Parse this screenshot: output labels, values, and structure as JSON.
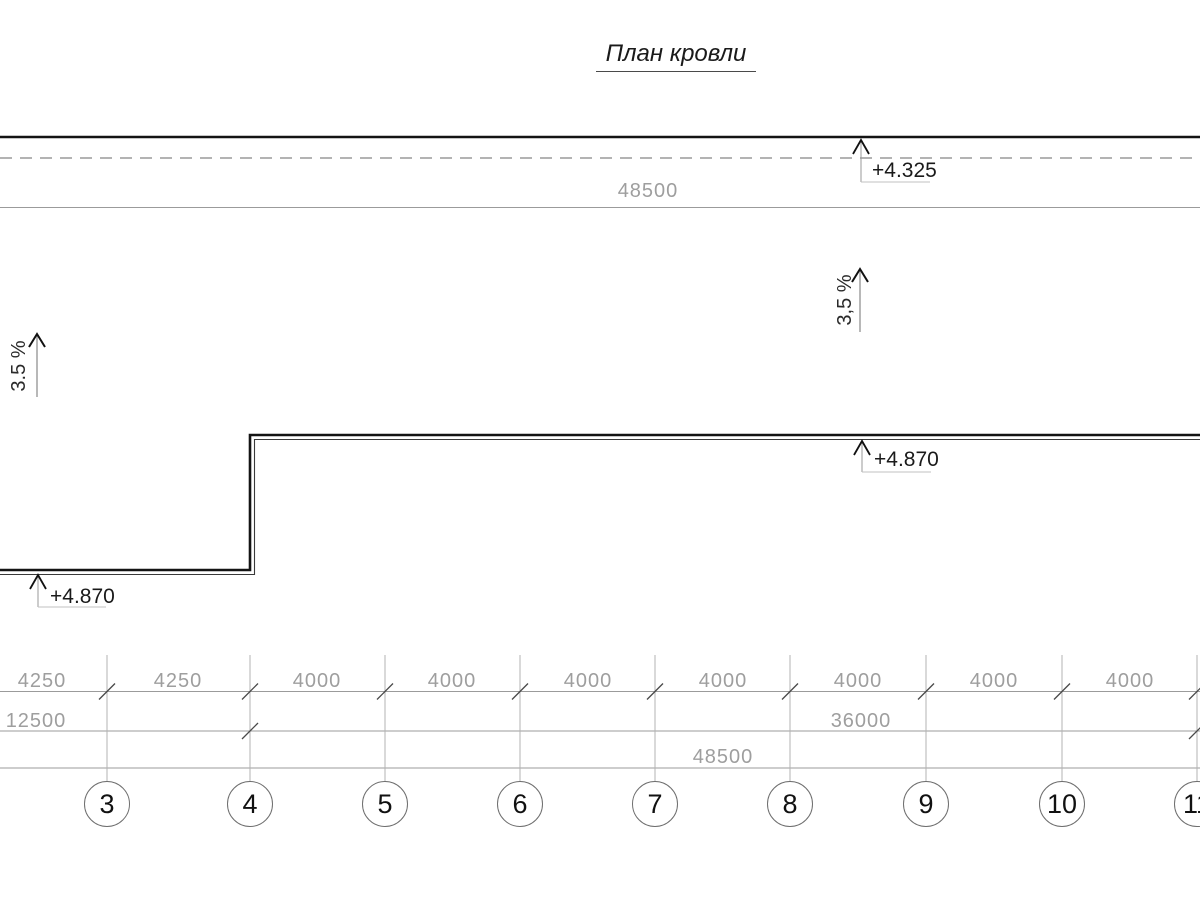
{
  "title": "План кровли",
  "colors": {
    "line_dark": "#141414",
    "line_inner": "#3a3a3a",
    "dashed": "#9a9a9a",
    "dim_line": "#9b9b9b",
    "dim_text": "#9e9e9e",
    "grid_line": "#b3b3b3",
    "tick": "#4a4a4a",
    "leader": "#c2c2c2",
    "marker_shaft": "#999999",
    "arrow": "#111111",
    "bubble_stroke": "#6e6e6e"
  },
  "elevations": {
    "top": {
      "label": "+4.325"
    },
    "roof_right": {
      "label": "+4.870"
    },
    "roof_left": {
      "label": "+4.870"
    }
  },
  "slopes": {
    "left": "3.5 %",
    "right": "3,5 %"
  },
  "dimensions": {
    "top_row": {
      "y": 181,
      "items": [
        {
          "label": "48500",
          "x": 648
        }
      ]
    },
    "row1": {
      "y": 671,
      "items": [
        {
          "label": "4250",
          "x": 42
        },
        {
          "label": "4250",
          "x": 178
        },
        {
          "label": "4000",
          "x": 317
        },
        {
          "label": "4000",
          "x": 452
        },
        {
          "label": "4000",
          "x": 588
        },
        {
          "label": "4000",
          "x": 723
        },
        {
          "label": "4000",
          "x": 858
        },
        {
          "label": "4000",
          "x": 994
        },
        {
          "label": "4000",
          "x": 1130
        }
      ]
    },
    "row2": {
      "y": 711,
      "items": [
        {
          "label": "12500",
          "x": 36
        },
        {
          "label": "36000",
          "x": 861
        }
      ]
    },
    "row3": {
      "y": 747,
      "items": [
        {
          "label": "48500",
          "x": 723
        }
      ]
    }
  },
  "grid": {
    "bubbles": [
      {
        "label": "3",
        "x": 107
      },
      {
        "label": "4",
        "x": 250
      },
      {
        "label": "5",
        "x": 385
      },
      {
        "label": "6",
        "x": 520
      },
      {
        "label": "7",
        "x": 655
      },
      {
        "label": "8",
        "x": 790
      },
      {
        "label": "9",
        "x": 926
      },
      {
        "label": "10",
        "x": 1062
      },
      {
        "label": "11",
        "x": 1197
      }
    ],
    "row2_tick_xs": [
      250,
      1197
    ]
  }
}
